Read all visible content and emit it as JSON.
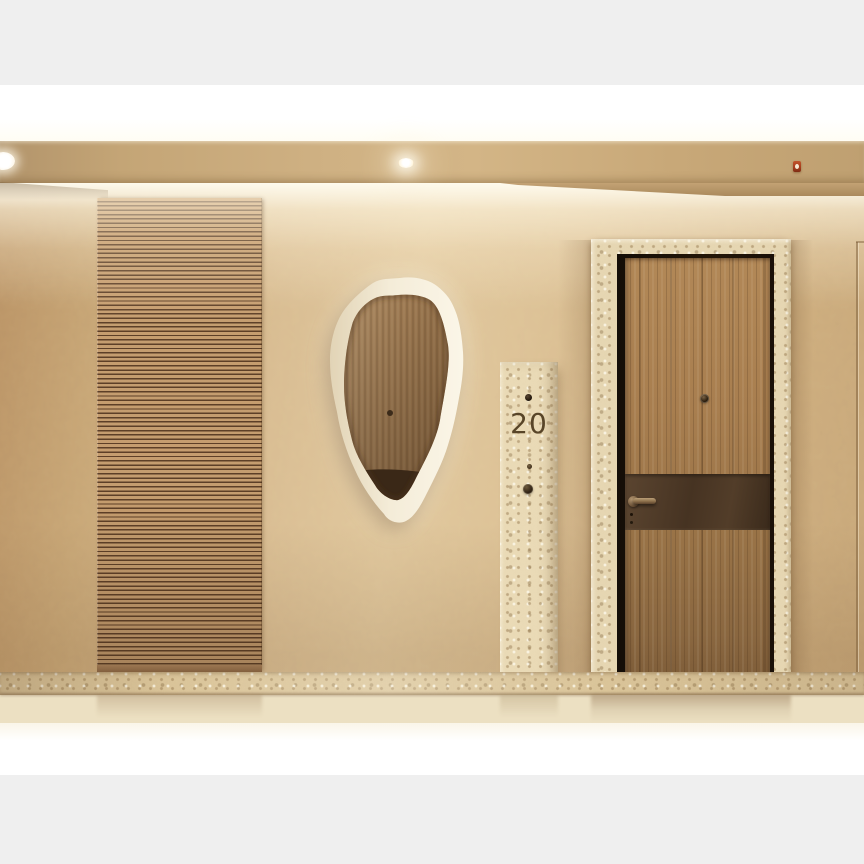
{
  "meta": {
    "content_type": "architectural-interior-rendering",
    "subject": "apartment corridor entrance with wooden door, slatted wood panel, organic backlit mirror and travertine details"
  },
  "unit_plate": {
    "number": "20"
  },
  "objects": {
    "ceiling": "ceiling-soffit-with-cove-light",
    "downlight": "recessed-downlight",
    "sprinkler": "fire-sprinkler-head",
    "wall": "textured-plaster-wall",
    "slat_panel": "horizontal-wood-slat-panel",
    "mirror": "organic-shaped-backlit-mirror",
    "unit_plate": "travertine-unit-number-plate",
    "doorbell": "doorbell-button",
    "door": "wooden-entrance-door",
    "door_band": "dark-bronze-accent-band",
    "door_handle": "lever-door-handle",
    "peephole": "door-peephole",
    "baseboard": "travertine-baseboard",
    "floor": "stone-floor"
  },
  "palette": {
    "letterbox_gray": "#efefef",
    "cove_white": "#ffffff",
    "fascia_tan": "#cfb183",
    "wall_light": "#e0c79d",
    "wall_dark": "#b89164",
    "slat_wood": "#c59d6f",
    "slat_gap": "#5d3f27",
    "stone_beige": "#e9d9b5",
    "door_wood": "#a87e4f",
    "bronze_band": "#463322",
    "number_brown": "#584528",
    "sprinkler_red": "#a53c1c",
    "floor_cream": "#ece0c2"
  }
}
